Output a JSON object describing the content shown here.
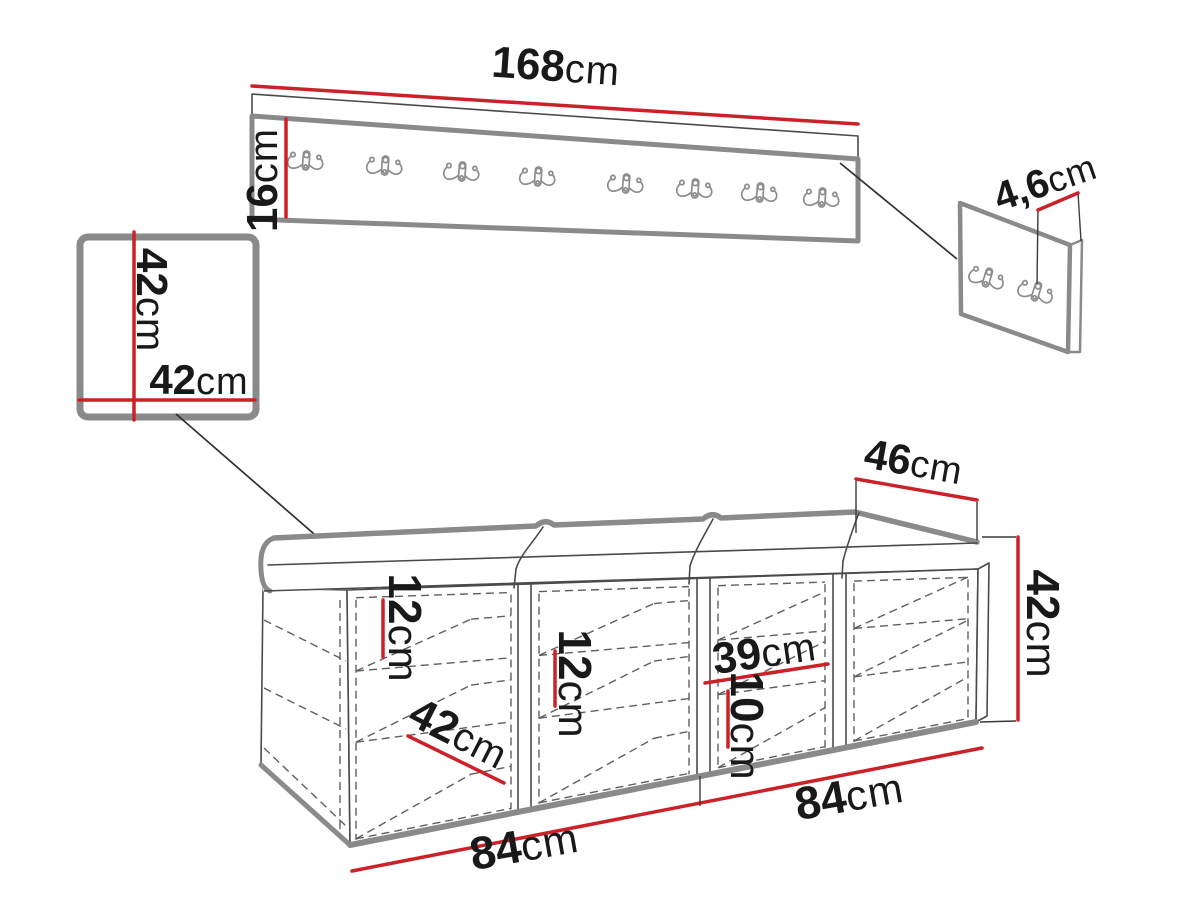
{
  "drawing": {
    "wall_hook_rack": {
      "width": {
        "value": "168",
        "unit": "cm"
      },
      "height": {
        "value": "16",
        "unit": "cm"
      },
      "hooks_count": 8
    },
    "small_hook_panel": {
      "depth": {
        "value": "4,6",
        "unit": "cm"
      },
      "hooks_count": 2
    },
    "wall_cabinet": {
      "height": {
        "value": "42",
        "unit": "cm"
      },
      "width": {
        "value": "42",
        "unit": "cm"
      }
    },
    "bench": {
      "depth": {
        "value": "46",
        "unit": "cm"
      },
      "height": {
        "value": "42",
        "unit": "cm"
      },
      "shelf_gap_left": {
        "value": "12",
        "unit": "cm"
      },
      "shelf_gap_middle": {
        "value": "12",
        "unit": "cm"
      },
      "inner_width": {
        "value": "39",
        "unit": "cm"
      },
      "shelf_height": {
        "value": "10",
        "unit": "cm"
      },
      "inner_depth": {
        "value": "42",
        "unit": "cm"
      },
      "module_width_left": {
        "value": "84",
        "unit": "cm"
      },
      "module_width_right": {
        "value": "84",
        "unit": "cm"
      },
      "cushions_count": 4,
      "compartments_count": 4
    }
  },
  "colors": {
    "accent": "#cc2128",
    "furniture_outline": "#8a8a8a",
    "line": "#3a3a3a",
    "background": "#ffffff"
  }
}
